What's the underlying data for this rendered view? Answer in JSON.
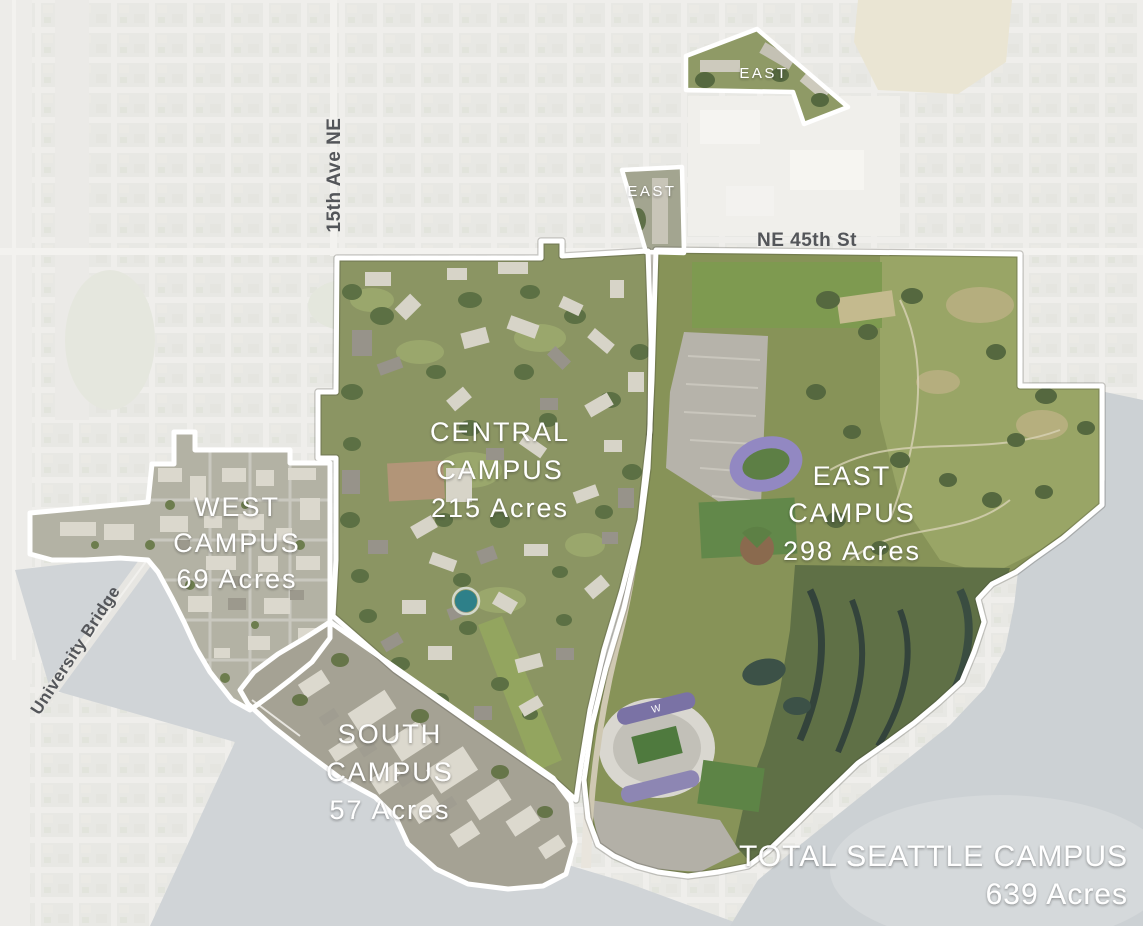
{
  "map": {
    "regions": {
      "west": {
        "lines": [
          "WEST",
          "CAMPUS",
          "69 Acres"
        ]
      },
      "central": {
        "lines": [
          "CENTRAL",
          "CAMPUS",
          "215 Acres"
        ]
      },
      "south": {
        "lines": [
          "SOUTH",
          "CAMPUS",
          "57 Acres"
        ]
      },
      "east": {
        "lines": [
          "EAST",
          "CAMPUS",
          "298 Acres"
        ]
      },
      "east_parcel_north": {
        "label": "EAST"
      },
      "east_parcel_west": {
        "label": "EAST"
      }
    },
    "streets": {
      "ne_45th": "NE 45th St",
      "fifteenth_ave": "15th Ave NE",
      "university_bridge": "University Bridge"
    },
    "total": {
      "line1": "TOTAL SEATTLE CAMPUS",
      "line2": "639 Acres"
    },
    "colors": {
      "boundary": "#ffffff",
      "campus_label": "#ffffff",
      "street_label": "#54565a",
      "faded_land": "#d8d7d1",
      "water": "#a7afb4",
      "campus_green": "#8b9563",
      "wetland_green": "#5f7046",
      "track_purple": "#9288c2"
    }
  }
}
